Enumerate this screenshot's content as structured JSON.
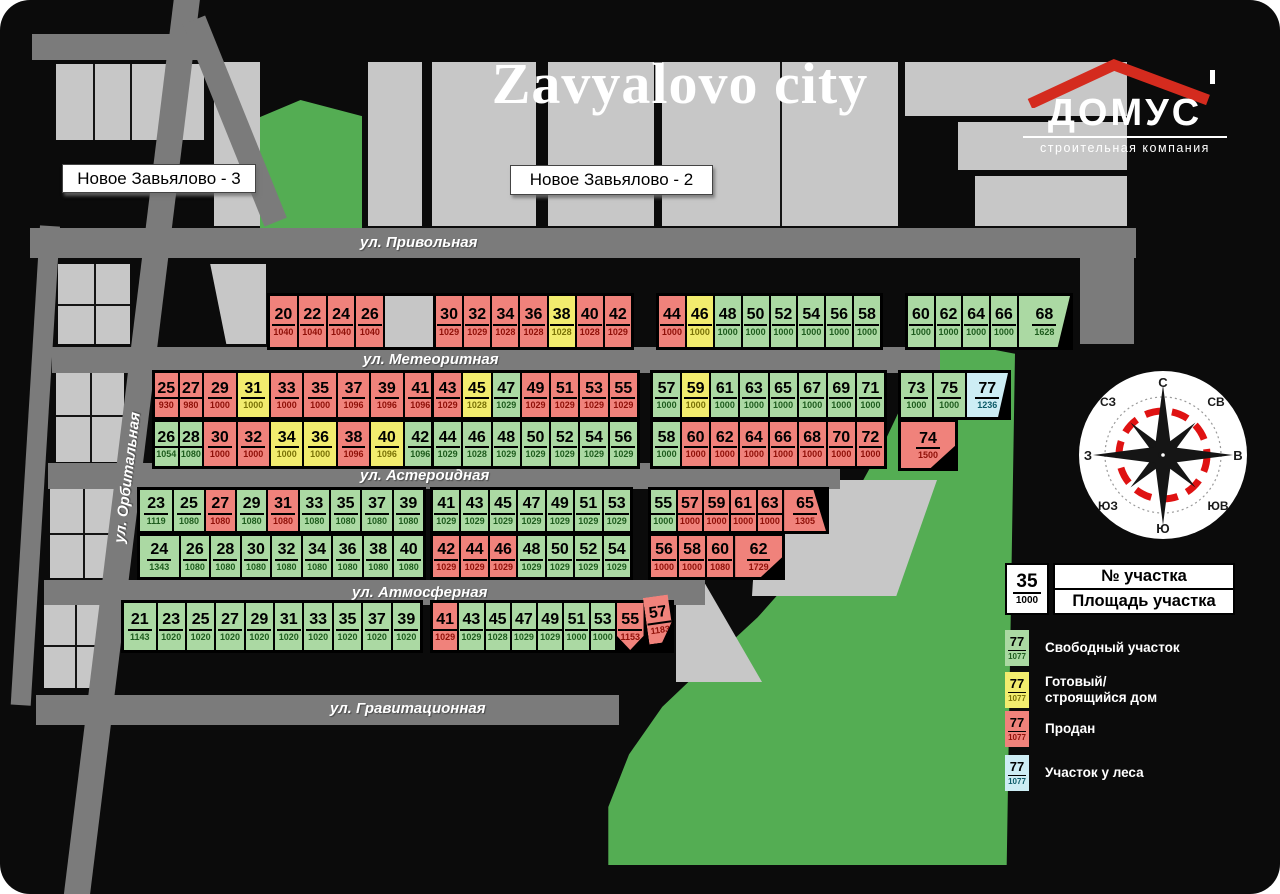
{
  "title": "Zavyalovo city",
  "logo": {
    "name": "ДОМУС",
    "subtitle": "строительная компания"
  },
  "district_labels": {
    "left": "Новое Завьялово - 3",
    "center": "Новое Завьялово - 2"
  },
  "streets": {
    "privolnaya": "ул. Привольная",
    "meteoritnaya": "ул. Метеоритная",
    "asteroidnaya": "ул. Астероидная",
    "atmosfernaya": "ул. Атмосферная",
    "gravitacionnaya": "ул. Гравитационная",
    "orbitalnaya": "ул. Орбитальная"
  },
  "compass": {
    "n": "С",
    "ne": "СВ",
    "e": "В",
    "se": "ЮВ",
    "s": "Ю",
    "sw": "ЮЗ",
    "w": "З",
    "nw": "СЗ"
  },
  "legend": {
    "key": {
      "number": "35",
      "area": "1000",
      "number_label": "№ участка",
      "area_label": "Площадь участка"
    },
    "items": [
      {
        "number": "77",
        "area": "1077",
        "status": "free",
        "label": "Свободный участок"
      },
      {
        "number": "77",
        "area": "1077",
        "status": "house",
        "label": "Готовый/ строящийся дом"
      },
      {
        "number": "77",
        "area": "1077",
        "status": "sold",
        "label": "Продан"
      },
      {
        "number": "77",
        "area": "1077",
        "status": "forest",
        "label": "Участок у леса"
      }
    ]
  },
  "status_colors": {
    "free": "#abd9a3",
    "house": "#f2ec6e",
    "sold": "#f0827b",
    "forest": "#cdedf4"
  },
  "map": {
    "blocks": [
      {
        "id": "a1",
        "plots": [
          {
            "n": "20",
            "a": "1040",
            "s": "sold"
          },
          {
            "n": "22",
            "a": "1040",
            "s": "sold"
          },
          {
            "n": "24",
            "a": "1040",
            "s": "sold"
          },
          {
            "n": "26",
            "a": "1040",
            "s": "sold"
          },
          {
            "s": "empty"
          }
        ]
      },
      {
        "id": "a2",
        "plots": [
          {
            "n": "30",
            "a": "1029",
            "s": "sold"
          },
          {
            "n": "32",
            "a": "1029",
            "s": "sold"
          },
          {
            "n": "34",
            "a": "1028",
            "s": "sold"
          },
          {
            "n": "36",
            "a": "1028",
            "s": "sold"
          },
          {
            "n": "38",
            "a": "1028",
            "s": "house"
          },
          {
            "n": "40",
            "a": "1028",
            "s": "sold"
          },
          {
            "n": "42",
            "a": "1029",
            "s": "sold"
          }
        ]
      },
      {
        "id": "a3",
        "plots": [
          {
            "n": "44",
            "a": "1000",
            "s": "sold"
          },
          {
            "n": "46",
            "a": "1000",
            "s": "house"
          },
          {
            "n": "48",
            "a": "1000",
            "s": "free"
          },
          {
            "n": "50",
            "a": "1000",
            "s": "free"
          },
          {
            "n": "52",
            "a": "1000",
            "s": "free"
          },
          {
            "n": "54",
            "a": "1000",
            "s": "free"
          },
          {
            "n": "56",
            "a": "1000",
            "s": "free"
          },
          {
            "n": "58",
            "a": "1000",
            "s": "free"
          }
        ]
      },
      {
        "id": "a4",
        "plots": [
          {
            "n": "60",
            "a": "1000",
            "s": "free"
          },
          {
            "n": "62",
            "a": "1000",
            "s": "free"
          },
          {
            "n": "64",
            "a": "1000",
            "s": "free"
          },
          {
            "n": "66",
            "a": "1000",
            "s": "free"
          },
          {
            "n": "68",
            "a": "1628",
            "s": "free"
          }
        ]
      },
      {
        "id": "b1a",
        "plots": [
          {
            "n": "25",
            "a": "930",
            "s": "sold"
          },
          {
            "n": "27",
            "a": "980",
            "s": "sold"
          },
          {
            "n": "29",
            "a": "1000",
            "s": "sold"
          },
          {
            "n": "31",
            "a": "1000",
            "s": "house"
          },
          {
            "n": "33",
            "a": "1000",
            "s": "sold"
          },
          {
            "n": "35",
            "a": "1000",
            "s": "sold"
          },
          {
            "n": "37",
            "a": "1096",
            "s": "sold"
          },
          {
            "n": "39",
            "a": "1096",
            "s": "sold"
          },
          {
            "n": "41",
            "a": "1096",
            "s": "sold"
          }
        ]
      },
      {
        "id": "b1b",
        "plots": [
          {
            "n": "43",
            "a": "1029",
            "s": "sold"
          },
          {
            "n": "45",
            "a": "1028",
            "s": "house"
          },
          {
            "n": "47",
            "a": "1029",
            "s": "free"
          },
          {
            "n": "49",
            "a": "1029",
            "s": "sold"
          },
          {
            "n": "51",
            "a": "1029",
            "s": "sold"
          },
          {
            "n": "53",
            "a": "1029",
            "s": "sold"
          },
          {
            "n": "55",
            "a": "1029",
            "s": "sold"
          }
        ]
      },
      {
        "id": "b1c",
        "plots": [
          {
            "n": "57",
            "a": "1000",
            "s": "free"
          },
          {
            "n": "59",
            "a": "1000",
            "s": "house"
          },
          {
            "n": "61",
            "a": "1000",
            "s": "free"
          },
          {
            "n": "63",
            "a": "1000",
            "s": "free"
          },
          {
            "n": "65",
            "a": "1000",
            "s": "free"
          },
          {
            "n": "67",
            "a": "1000",
            "s": "free"
          },
          {
            "n": "69",
            "a": "1000",
            "s": "free"
          },
          {
            "n": "71",
            "a": "1000",
            "s": "free"
          }
        ]
      },
      {
        "id": "b1d",
        "plots": [
          {
            "n": "73",
            "a": "1000",
            "s": "free"
          },
          {
            "n": "75",
            "a": "1000",
            "s": "free"
          },
          {
            "n": "77",
            "a": "1236",
            "s": "forest"
          }
        ]
      },
      {
        "id": "b2a",
        "plots": [
          {
            "n": "26",
            "a": "1054",
            "s": "free"
          },
          {
            "n": "28",
            "a": "1080",
            "s": "free"
          },
          {
            "n": "30",
            "a": "1000",
            "s": "sold"
          },
          {
            "n": "32",
            "a": "1000",
            "s": "sold"
          },
          {
            "n": "34",
            "a": "1000",
            "s": "house"
          },
          {
            "n": "36",
            "a": "1000",
            "s": "house"
          },
          {
            "n": "38",
            "a": "1096",
            "s": "sold"
          },
          {
            "n": "40",
            "a": "1096",
            "s": "house"
          },
          {
            "n": "42",
            "a": "1096",
            "s": "free"
          }
        ]
      },
      {
        "id": "b2b",
        "plots": [
          {
            "n": "44",
            "a": "1029",
            "s": "free"
          },
          {
            "n": "46",
            "a": "1028",
            "s": "free"
          },
          {
            "n": "48",
            "a": "1029",
            "s": "free"
          },
          {
            "n": "50",
            "a": "1029",
            "s": "free"
          },
          {
            "n": "52",
            "a": "1029",
            "s": "free"
          },
          {
            "n": "54",
            "a": "1029",
            "s": "free"
          },
          {
            "n": "56",
            "a": "1029",
            "s": "free"
          }
        ]
      },
      {
        "id": "b2c",
        "plots": [
          {
            "n": "58",
            "a": "1000",
            "s": "free"
          },
          {
            "n": "60",
            "a": "1000",
            "s": "sold"
          },
          {
            "n": "62",
            "a": "1000",
            "s": "sold"
          },
          {
            "n": "64",
            "a": "1000",
            "s": "sold"
          },
          {
            "n": "66",
            "a": "1000",
            "s": "sold"
          },
          {
            "n": "68",
            "a": "1000",
            "s": "sold"
          },
          {
            "n": "70",
            "a": "1000",
            "s": "sold"
          },
          {
            "n": "72",
            "a": "1000",
            "s": "sold"
          }
        ]
      },
      {
        "id": "b2d",
        "plots": [
          {
            "n": "74",
            "a": "1500",
            "s": "sold"
          }
        ]
      },
      {
        "id": "c1a",
        "plots": [
          {
            "n": "23",
            "a": "1119",
            "s": "free"
          },
          {
            "n": "25",
            "a": "1080",
            "s": "free"
          },
          {
            "n": "27",
            "a": "1080",
            "s": "sold"
          },
          {
            "n": "29",
            "a": "1080",
            "s": "free"
          },
          {
            "n": "31",
            "a": "1080",
            "s": "sold"
          },
          {
            "n": "33",
            "a": "1080",
            "s": "free"
          },
          {
            "n": "35",
            "a": "1080",
            "s": "free"
          },
          {
            "n": "37",
            "a": "1080",
            "s": "free"
          },
          {
            "n": "39",
            "a": "1080",
            "s": "free"
          }
        ]
      },
      {
        "id": "c1b",
        "plots": [
          {
            "n": "41",
            "a": "1029",
            "s": "free"
          },
          {
            "n": "43",
            "a": "1029",
            "s": "free"
          },
          {
            "n": "45",
            "a": "1029",
            "s": "free"
          },
          {
            "n": "47",
            "a": "1029",
            "s": "free"
          },
          {
            "n": "49",
            "a": "1029",
            "s": "free"
          },
          {
            "n": "51",
            "a": "1029",
            "s": "free"
          },
          {
            "n": "53",
            "a": "1029",
            "s": "free"
          }
        ]
      },
      {
        "id": "c1c",
        "plots": [
          {
            "n": "55",
            "a": "1000",
            "s": "free"
          },
          {
            "n": "57",
            "a": "1000",
            "s": "sold"
          },
          {
            "n": "59",
            "a": "1000",
            "s": "sold"
          },
          {
            "n": "61",
            "a": "1000",
            "s": "sold"
          },
          {
            "n": "63",
            "a": "1000",
            "s": "sold"
          },
          {
            "n": "65",
            "a": "1305",
            "s": "sold"
          }
        ]
      },
      {
        "id": "c2a",
        "plots": [
          {
            "n": "24",
            "a": "1343",
            "s": "free"
          },
          {
            "n": "26",
            "a": "1080",
            "s": "free"
          },
          {
            "n": "28",
            "a": "1080",
            "s": "free"
          },
          {
            "n": "30",
            "a": "1080",
            "s": "free"
          },
          {
            "n": "32",
            "a": "1080",
            "s": "free"
          },
          {
            "n": "34",
            "a": "1080",
            "s": "free"
          },
          {
            "n": "36",
            "a": "1080",
            "s": "free"
          },
          {
            "n": "38",
            "a": "1080",
            "s": "free"
          },
          {
            "n": "40",
            "a": "1080",
            "s": "free"
          }
        ]
      },
      {
        "id": "c2b",
        "plots": [
          {
            "n": "42",
            "a": "1029",
            "s": "sold"
          },
          {
            "n": "44",
            "a": "1029",
            "s": "sold"
          },
          {
            "n": "46",
            "a": "1029",
            "s": "sold"
          },
          {
            "n": "48",
            "a": "1029",
            "s": "free"
          },
          {
            "n": "50",
            "a": "1029",
            "s": "free"
          },
          {
            "n": "52",
            "a": "1029",
            "s": "free"
          },
          {
            "n": "54",
            "a": "1029",
            "s": "free"
          }
        ]
      },
      {
        "id": "c2c",
        "plots": [
          {
            "n": "56",
            "a": "1000",
            "s": "sold"
          },
          {
            "n": "58",
            "a": "1000",
            "s": "sold"
          },
          {
            "n": "60",
            "a": "1080",
            "s": "sold"
          },
          {
            "n": "62",
            "a": "1729",
            "s": "sold"
          }
        ]
      },
      {
        "id": "d1",
        "plots": [
          {
            "n": "21",
            "a": "1143",
            "s": "free"
          },
          {
            "n": "23",
            "a": "1020",
            "s": "free"
          },
          {
            "n": "25",
            "a": "1020",
            "s": "free"
          },
          {
            "n": "27",
            "a": "1020",
            "s": "free"
          },
          {
            "n": "29",
            "a": "1020",
            "s": "free"
          },
          {
            "n": "31",
            "a": "1020",
            "s": "free"
          },
          {
            "n": "33",
            "a": "1020",
            "s": "free"
          },
          {
            "n": "35",
            "a": "1020",
            "s": "free"
          },
          {
            "n": "37",
            "a": "1020",
            "s": "free"
          },
          {
            "n": "39",
            "a": "1020",
            "s": "free"
          }
        ]
      },
      {
        "id": "d2",
        "plots": [
          {
            "n": "41",
            "a": "1029",
            "s": "sold"
          },
          {
            "n": "43",
            "a": "1029",
            "s": "free"
          },
          {
            "n": "45",
            "a": "1028",
            "s": "free"
          },
          {
            "n": "47",
            "a": "1029",
            "s": "free"
          },
          {
            "n": "49",
            "a": "1029",
            "s": "free"
          },
          {
            "n": "51",
            "a": "1000",
            "s": "free"
          },
          {
            "n": "53",
            "a": "1000",
            "s": "free"
          },
          {
            "n": "55",
            "a": "1153",
            "s": "sold"
          },
          {
            "n": "57",
            "a": "1183",
            "s": "sold"
          }
        ]
      }
    ]
  }
}
